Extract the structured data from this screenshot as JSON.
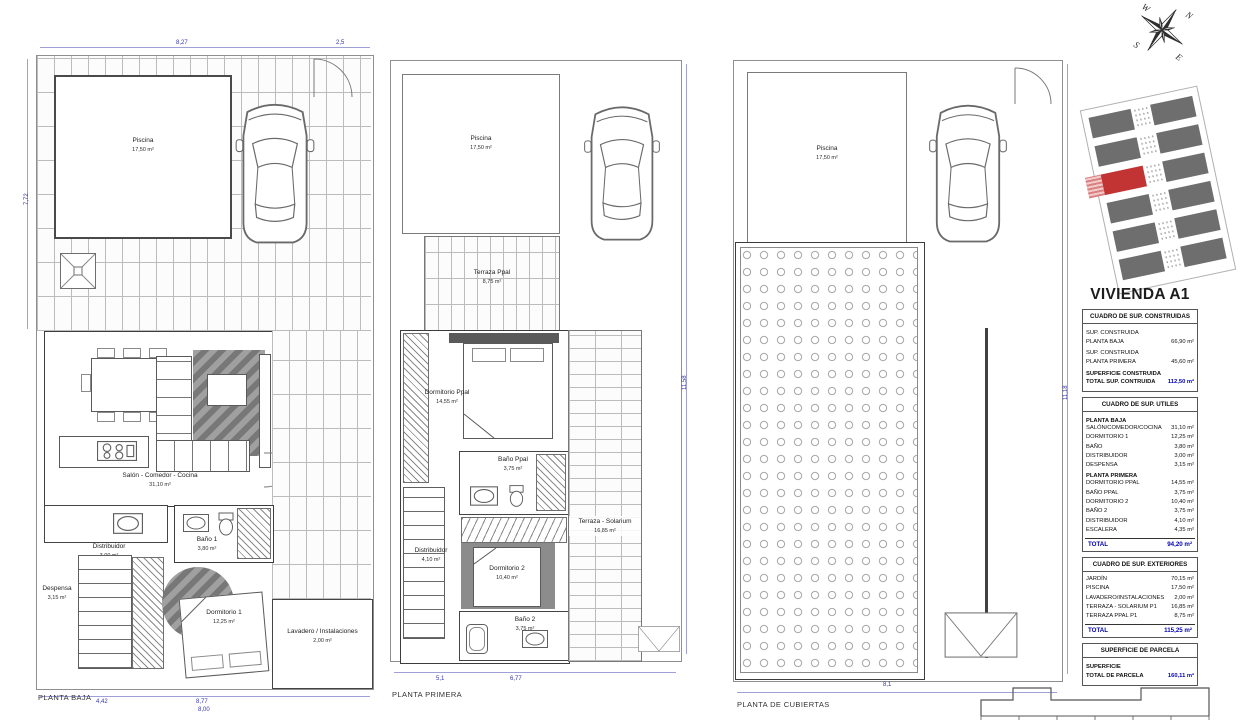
{
  "sheet_title": "VIVIENDA A1",
  "compass": {
    "n": "N",
    "s": "S",
    "e": "E",
    "w": "W"
  },
  "plans": [
    {
      "name": "PLANTA BAJA",
      "rooms": {
        "piscina": {
          "label": "Piscina",
          "area": "17,50 m²"
        },
        "salon": {
          "label": "Salón - Comedor - Cocina",
          "area": "31,10 m²"
        },
        "distribuidor": {
          "label": "Distribuidor",
          "area": "3,00 m²"
        },
        "bano1": {
          "label": "Baño 1",
          "area": "3,80 m²"
        },
        "despensa": {
          "label": "Despensa",
          "area": "3,15 m²"
        },
        "dormitorio1": {
          "label": "Dormitorio 1",
          "area": "12,25 m²"
        },
        "lavadero": {
          "label": "Lavadero / Instalaciones",
          "area": "2,00 m²"
        }
      },
      "dims": [
        "8,27",
        "2,5",
        "7,72",
        "4,42",
        "8,77",
        "8,00"
      ]
    },
    {
      "name": "PLANTA PRIMERA",
      "rooms": {
        "piscina": {
          "label": "Piscina",
          "area": "17,50 m²"
        },
        "terraza_ppal": {
          "label": "Terraza Ppal",
          "area": "8,75 m²"
        },
        "dorm_ppal": {
          "label": "Dormitorio Ppal",
          "area": "14,55 m²"
        },
        "bano_ppal": {
          "label": "Baño Ppal",
          "area": "3,75 m²"
        },
        "distribuidor": {
          "label": "Distribuidor",
          "area": "4,10 m²"
        },
        "dormitorio2": {
          "label": "Dormitorio 2",
          "area": "10,40 m²"
        },
        "bano2": {
          "label": "Baño 2",
          "area": "3,75 m²"
        },
        "solarium": {
          "label": "Terraza - Solarium",
          "area": "16,85 m²"
        }
      },
      "dims": [
        "6,77",
        "5,1",
        "11,58"
      ]
    },
    {
      "name": "PLANTA DE CUBIERTAS",
      "rooms": {
        "piscina": {
          "label": "Piscina",
          "area": "17,50 m²"
        }
      },
      "dims": [
        "8,1",
        "11,18"
      ]
    }
  ],
  "summary": {
    "construidas": {
      "header": "CUADRO DE SUP. CONSTRUIDAS",
      "rows": [
        {
          "l1": "SUP. CONSTRUIDA",
          "l2": "PLANTA BAJA",
          "v": "66,90 m²"
        },
        {
          "l1": "SUP. CONSTRUIDA",
          "l2": "PLANTA PRIMERA",
          "v": "45,60 m²"
        },
        {
          "l1": "SUPERFICIE CONSTRUIDA",
          "l2": "TOTAL SUP. CONTRUIDA",
          "v": "112,50 m²"
        }
      ]
    },
    "utiles": {
      "header": "CUADRO DE SUP. UTILES",
      "group1": "PLANTA BAJA",
      "rows1": [
        {
          "l": "SALÓN/COMEDOR/COCINA",
          "v": "31,10 m²"
        },
        {
          "l": "DORMITORIO 1",
          "v": "12,25 m²"
        },
        {
          "l": "BAÑO",
          "v": "3,80 m²"
        },
        {
          "l": "DISTRIBUIDOR",
          "v": "3,00 m²"
        },
        {
          "l": "DESPENSA",
          "v": "3,15 m²"
        }
      ],
      "group2": "PLANTA PRIMERA",
      "rows2": [
        {
          "l": "DORMITORIO PPAL",
          "v": "14,55 m²"
        },
        {
          "l": "BAÑO PPAL",
          "v": "3,75 m²"
        },
        {
          "l": "DORMITORIO 2",
          "v": "10,40 m²"
        },
        {
          "l": "BAÑO 2",
          "v": "3,75 m²"
        },
        {
          "l": "DISTRIBUIDOR",
          "v": "4,10 m²"
        },
        {
          "l": "ESCALERA",
          "v": "4,35 m²"
        }
      ],
      "total_label": "TOTAL",
      "total": "94,20 m²"
    },
    "exteriores": {
      "header": "CUADRO DE SUP. EXTERIORES",
      "rows": [
        {
          "l": "JARDÍN",
          "v": "70,15 m²"
        },
        {
          "l": "PISCINA",
          "v": "17,50 m²"
        },
        {
          "l": "LAVADERO/INSTALACIONES",
          "v": "2,00 m²"
        },
        {
          "l": "TERRAZA - SOLARIUM P1",
          "v": "16,85 m²"
        },
        {
          "l": "TERRAZA PPAL P1",
          "v": "8,75 m²"
        }
      ],
      "total_label": "TOTAL",
      "total": "115,25 m²"
    },
    "parcela": {
      "header": "SUPERFICIE DE PARCELA",
      "row": {
        "l1": "SUPERFICIE",
        "l2": "TOTAL DE PARCELA",
        "v": "160,11 m²"
      }
    }
  },
  "colors": {
    "dim_blue": "#3434b0",
    "total_blue": "#0000b4",
    "unit_red": "#c23434"
  }
}
